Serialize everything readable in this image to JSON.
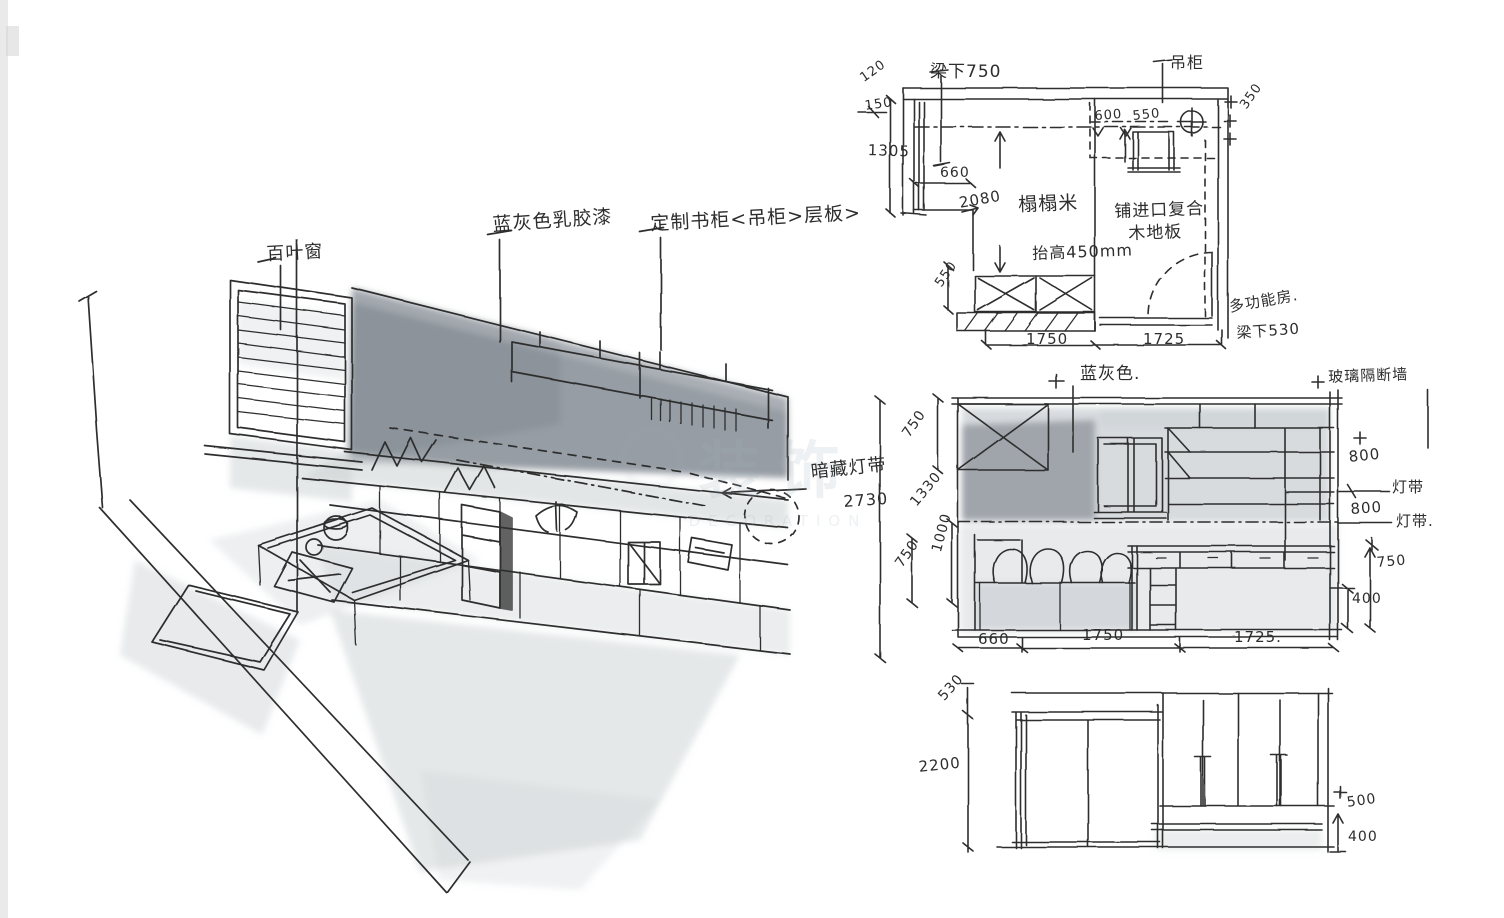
{
  "colors": {
    "ink": "#2d2d2d",
    "wash_dark": "#79828a",
    "wash_mid": "#a7afb5",
    "wash_light": "#ccd1d4",
    "watermark": "#9fb0bc",
    "paper": "#ffffff"
  },
  "watermark": {
    "cn": "装饰",
    "en": "DECORATION"
  },
  "perspective": {
    "labels": {
      "louver_window": "百叶窗",
      "wall_paint": "蓝灰色乳胶漆",
      "custom_bookshelf": "定制书柜<吊柜>层板>",
      "hidden_light_strip": "暗藏灯带"
    }
  },
  "plan": {
    "labels": {
      "beam_under": "梁下750",
      "hanging_cabinet": "吊柜",
      "tatami": "榻榻米",
      "raised": "抬高450mm",
      "floor_line1": "铺进口复合",
      "floor_line2": "木地板",
      "room_name": "多功能房.",
      "beam_under_door": "梁下530"
    },
    "dims": {
      "left_a": "120",
      "left_b": "150",
      "left_c": "1305",
      "alcove": "660",
      "depth": "2080",
      "cab_a": "600",
      "cab_b": "550",
      "right": "350",
      "seat": "550",
      "bottom_a": "1750",
      "bottom_b": "1725"
    }
  },
  "elevation_mid": {
    "labels": {
      "paint": "蓝灰色.",
      "glass_partition": "玻璃隔断墙",
      "strip_a": "灯带",
      "strip_b": "灯带."
    },
    "dims": {
      "total": "2730",
      "left_a": "750",
      "left_b": "1330",
      "left_c": "1000",
      "left_d": "750",
      "right_a": "800",
      "right_b": "800",
      "right_c": "750",
      "right_d": "400",
      "bottom_a": "660",
      "bottom_b": "1750",
      "bottom_c": "1725."
    }
  },
  "elevation_bottom": {
    "dims": {
      "top": "530",
      "left": "2200",
      "right_a": "500",
      "right_b": "400"
    }
  }
}
